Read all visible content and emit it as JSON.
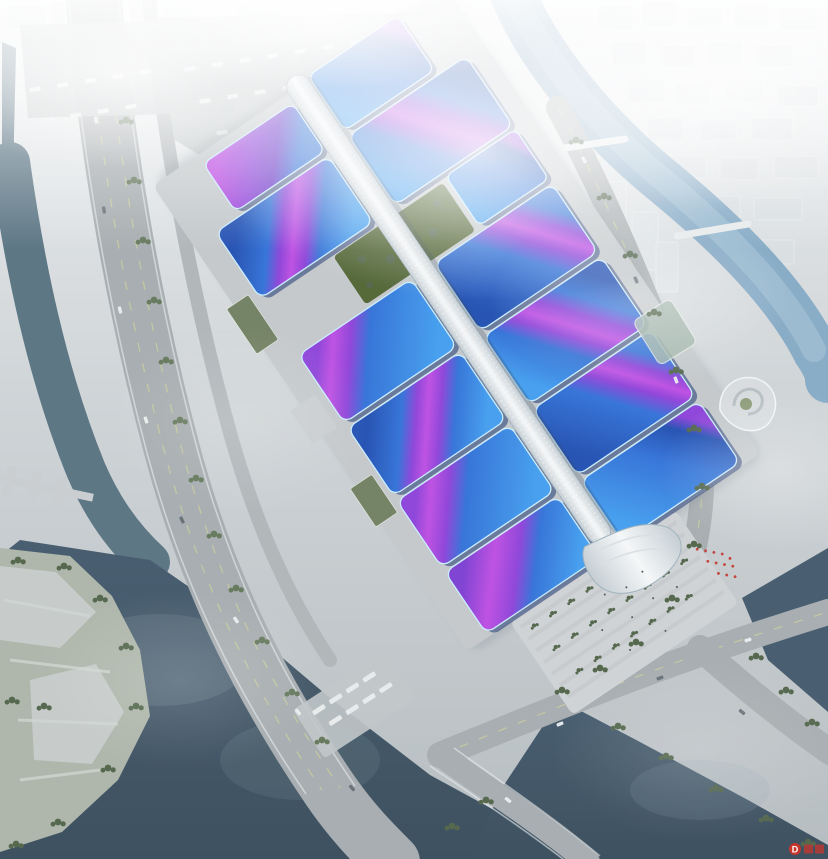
{
  "scene": {
    "type": "architectural-aerial-rendering",
    "description": "Hazy aerial rendering of a riverside exhibition and convention center: paired wavy exhibition-hall roofs in blue with sweeping purple ribbons flank a white central concourse spine ending in a curved entrance canopy beside a tree-lined arrival plaza with red flags; highways, canals, dark river basins and fog-softened city blocks surround the site."
  },
  "watermark": {
    "letter": "D"
  },
  "regions": [
    "city-skyline",
    "north-river",
    "river-bridges",
    "west-highway",
    "west-canal",
    "exhibition-complex",
    "hall-roofs",
    "central-spine",
    "garden-strip",
    "entrance-canopy",
    "arrival-plaza",
    "flag-cluster",
    "truck-parking",
    "bus-parking",
    "landmark-building",
    "south-water-basins",
    "riverside-park"
  ],
  "colors": {
    "bg_top": "#eef1f2",
    "bg_mid": "#ced3d6",
    "bg_bottom": "#b3babe",
    "city_block": "#dadfe2",
    "city_tower": "#dde2e5",
    "river_upper": "#84a9c5",
    "river_light": "#a7c4d7",
    "water_channel": "#55707f",
    "water_dark": "#40576a",
    "water_deep": "#344858",
    "park_green": "#abb3a7",
    "tree_dark": "#4d6146",
    "tree_mid": "#607457",
    "lawn_green": "#4c612f",
    "road": "#a4aaad",
    "road_light": "#aeb4b7",
    "lane_yellow": "#d5d795",
    "concrete": "#c8ccce",
    "plaza": "#cdd1d3",
    "apron": "#c2c7ca",
    "lot": "#bfc4c7",
    "roof_blue_deep": "#1d4cb0",
    "roof_blue": "#2e6fd6",
    "roof_blue_bright": "#3f9bee",
    "roof_navy": "#152e6b",
    "roof_trim": "#c9ecff",
    "ribbon_purple": "#8b3fd8",
    "ribbon_magenta": "#bc4ae2",
    "spine_light": "#f5f7f8",
    "spine_shade": "#c3ccd2",
    "vehicle_white": "#eaedee",
    "vehicle_dark": "#5b656c",
    "flag_red": "#c23a33",
    "watermark_red": "#c8352c",
    "shed_green": "#6e7d5e",
    "landmark_green": "#7d8d63",
    "glass_green": "#9fb4a8"
  }
}
